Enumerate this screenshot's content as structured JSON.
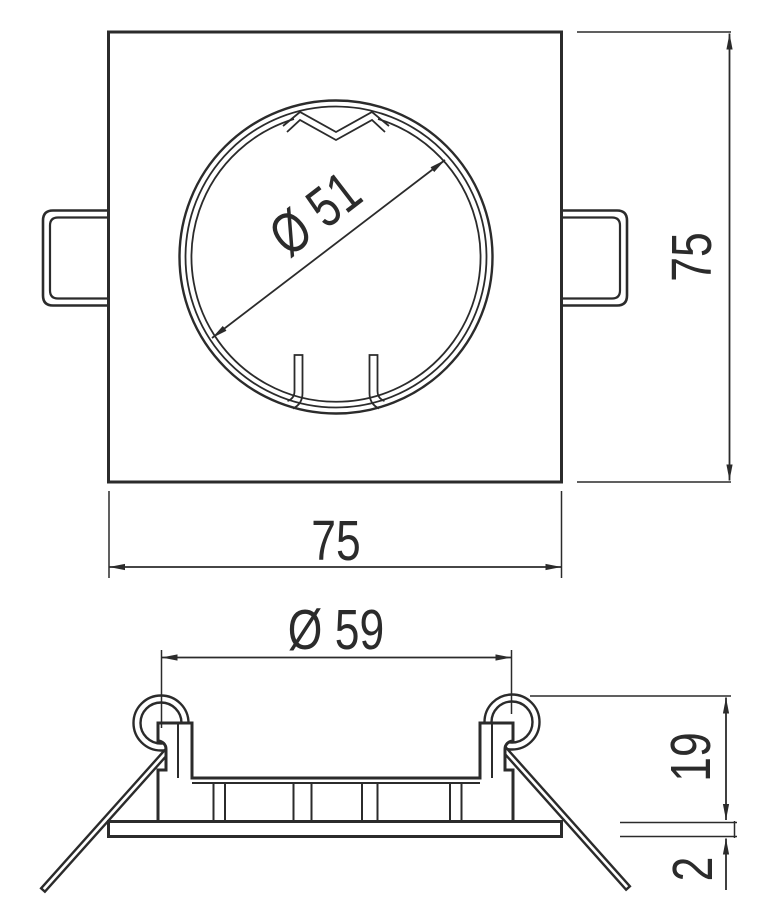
{
  "drawing": {
    "background": "#ffffff",
    "line_color": "#2b2b2b",
    "top_view": {
      "width_label": "75",
      "height_label": "75",
      "cutout_diameter_label": "Ø 51"
    },
    "section_view": {
      "outer_diameter_label": "Ø 59",
      "recess_height_label": "19",
      "flange_thickness_label": "2"
    }
  }
}
